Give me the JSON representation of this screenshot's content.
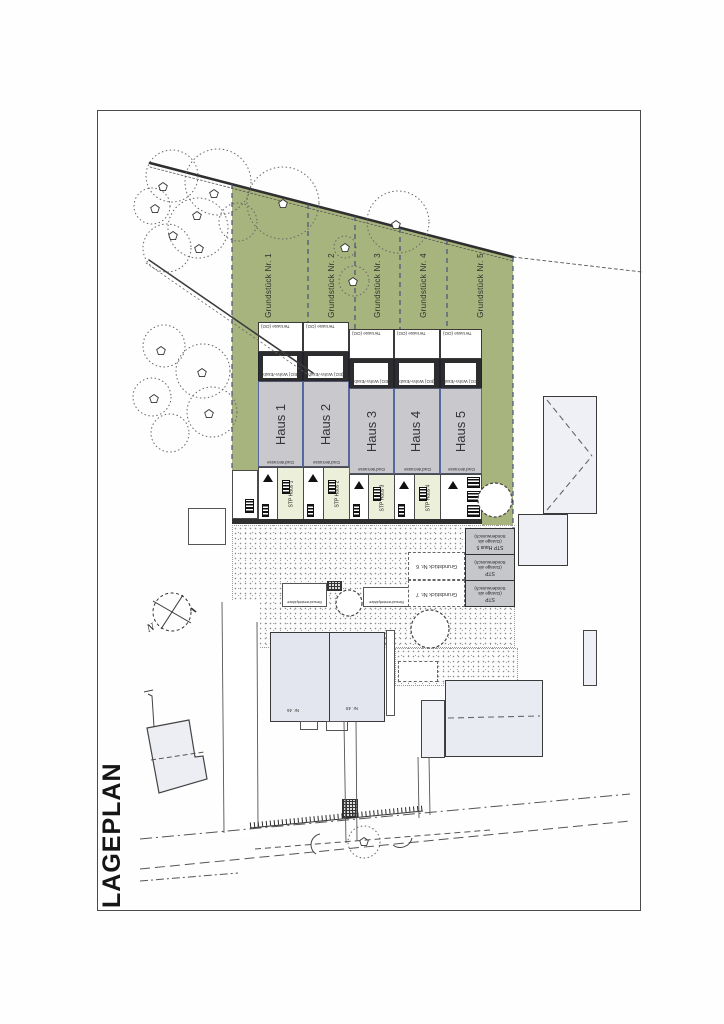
{
  "page": {
    "title": "LAGEPLAN"
  },
  "compass": {
    "label": "N"
  },
  "plots": [
    {
      "label": "Grundstück Nr. 1"
    },
    {
      "label": "Grundstück Nr. 2"
    },
    {
      "label": "Grundstück Nr. 3"
    },
    {
      "label": "Grundstück Nr. 4"
    },
    {
      "label": "Grundstück Nr. 5"
    }
  ],
  "rear_plots": [
    {
      "label": "Grundstück Nr. 6"
    },
    {
      "label": "Grundstück Nr. 7"
    }
  ],
  "houses": [
    {
      "name": "Haus 1",
      "terrace": "Terrasse (OG)",
      "upper": "(EG) Wohn-/Essb.",
      "lower": "Dachterrasse",
      "stp": "STP Haus 1"
    },
    {
      "name": "Haus 2",
      "terrace": "Terrasse (OG)",
      "upper": "(EG) Wohn-/Essb.",
      "lower": "Dachterrasse",
      "stp": "STP Haus 2"
    },
    {
      "name": "Haus 3",
      "terrace": "Terrasse (OG)",
      "upper": "(EG) Wohn-/Essb.",
      "lower": "Dachterrasse",
      "stp": "STP Haus 3"
    },
    {
      "name": "Haus 4",
      "sold": "Verkauft",
      "terrace": "Terrasse (OG)",
      "upper": "(EG) Wohn-/Essb.",
      "lower": "Dachterrasse",
      "stp": "STP Haus 4"
    },
    {
      "name": "Haus 5",
      "terrace": "Terrasse (OG)",
      "upper": "(EG) Wohn-/Essb.",
      "lower": "Dachterrasse"
    }
  ],
  "garages": [
    {
      "title": "STP Haus 5",
      "note": "(Garage als Sonderwunsch)"
    },
    {
      "title": "STP",
      "note": "(Garage als Sonderwunsch)"
    },
    {
      "title": "STP",
      "note": "(Garage als Sonderwunsch)"
    }
  ],
  "visitor_parking": {
    "label": "Besucherstellplätze"
  },
  "neighbors": [
    {
      "label": "Nr. 46"
    },
    {
      "label": "Nr. 48"
    }
  ],
  "colors": {
    "grass": "#a8b47d",
    "house_fill": "#c9c9cd",
    "sold_red": "#dd3540",
    "plot_line": "#46507c",
    "paving_cream": "#ecefd9"
  }
}
